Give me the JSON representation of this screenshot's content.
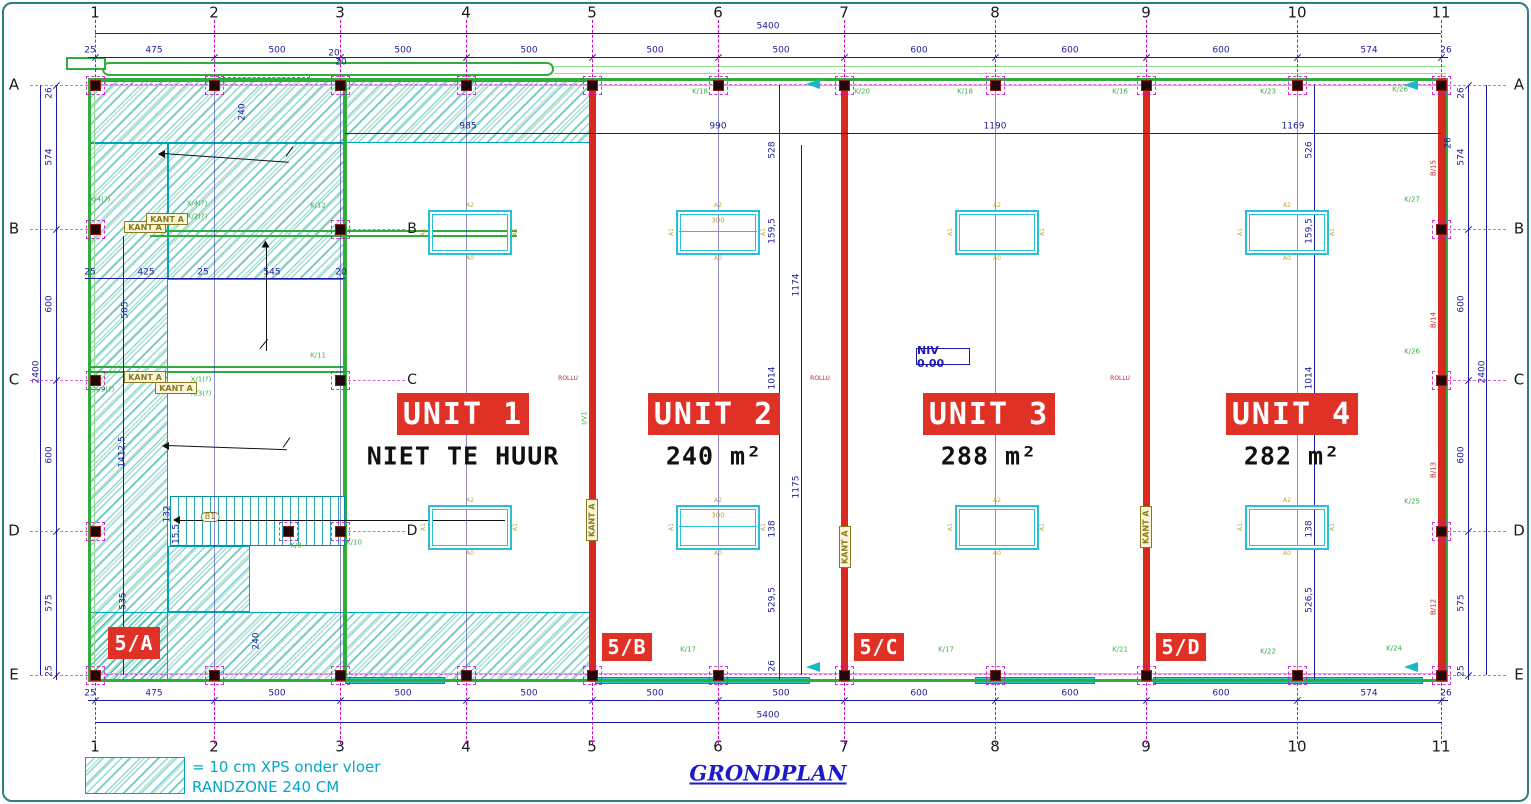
{
  "meta": {
    "title": "GRONDPLAN"
  },
  "colors": {
    "wall_red": "#d8291f",
    "wall_green": "#2fae3e",
    "teal": "#00b3c8",
    "dim_navy": "#1b1b9e",
    "grid_magenta": "#cc00cc",
    "label_green": "#3cb043",
    "banner_red": "#e03127",
    "khaki": "#8a7a1e",
    "niv_blue": "#1b1bb0",
    "legend_cyan": "#00a8cc"
  },
  "legend": {
    "line1": "= 10 cm XPS onder vloer",
    "line2": "RANDZONE 240 CM"
  },
  "niv": {
    "text": "NIV 0.00"
  },
  "kant_text": "KANT A",
  "grid": {
    "cols": [
      {
        "n": "1",
        "x": 95
      },
      {
        "n": "2",
        "x": 214
      },
      {
        "n": "3",
        "x": 340
      },
      {
        "n": "4",
        "x": 466
      },
      {
        "n": "5",
        "x": 592
      },
      {
        "n": "6",
        "x": 718
      },
      {
        "n": "7",
        "x": 844
      },
      {
        "n": "8",
        "x": 995
      },
      {
        "n": "9",
        "x": 1146
      },
      {
        "n": "10",
        "x": 1297
      },
      {
        "n": "11",
        "x": 1441
      }
    ],
    "inner_cols": [
      "2",
      "3",
      "4",
      "6",
      "8",
      "10"
    ],
    "rows": [
      {
        "n": "A",
        "y": 85
      },
      {
        "n": "B",
        "y": 229
      },
      {
        "n": "C",
        "y": 380
      },
      {
        "n": "D",
        "y": 531
      },
      {
        "n": "E",
        "y": 675
      }
    ]
  },
  "letters_inner": [
    {
      "n": "B",
      "x": 412,
      "y": 229
    },
    {
      "n": "C",
      "x": 412,
      "y": 380
    },
    {
      "n": "D",
      "x": 412,
      "y": 531
    }
  ],
  "banners": [
    {
      "label": "UNIT 1",
      "sub": "NIET TE HUUR",
      "bx": 397,
      "by": 393,
      "bw": 132,
      "bh": 42,
      "sx": 463,
      "sy": 456
    },
    {
      "label": "UNIT 2",
      "sub": "240 m²",
      "bx": 648,
      "by": 393,
      "bw": 132,
      "bh": 42,
      "sx": 714,
      "sy": 456
    },
    {
      "label": "UNIT 3",
      "sub": "288 m²",
      "bx": 923,
      "by": 393,
      "bw": 132,
      "bh": 42,
      "sx": 989,
      "sy": 456
    },
    {
      "label": "UNIT 4",
      "sub": "282 m²",
      "bx": 1226,
      "by": 393,
      "bw": 132,
      "bh": 42,
      "sx": 1292,
      "sy": 456
    }
  ],
  "zones": [
    {
      "label": "5/A",
      "x": 108,
      "y": 627,
      "w": 52,
      "h": 32
    },
    {
      "label": "5/B",
      "x": 602,
      "y": 633,
      "w": 50,
      "h": 28
    },
    {
      "label": "5/C",
      "x": 854,
      "y": 633,
      "w": 50,
      "h": 28
    },
    {
      "label": "5/D",
      "x": 1156,
      "y": 633,
      "w": 50,
      "h": 28
    }
  ],
  "kant": [
    {
      "x": 124,
      "y": 221
    },
    {
      "x": 146,
      "y": 213
    },
    {
      "x": 124,
      "y": 371
    },
    {
      "x": 155,
      "y": 382
    },
    {
      "x": 586,
      "y": 499,
      "v": 1
    },
    {
      "x": 839,
      "y": 526,
      "v": 1
    },
    {
      "x": 1140,
      "y": 506,
      "v": 1
    }
  ],
  "sky_labels": {
    "top": "A2",
    "bottom": "A0",
    "side": "A1"
  },
  "sky": [
    {
      "x": 428,
      "y": 210
    },
    {
      "x": 676,
      "y": 210,
      "mid": 1,
      "num": "300"
    },
    {
      "x": 955,
      "y": 210
    },
    {
      "x": 1245,
      "y": 210
    },
    {
      "x": 428,
      "y": 505
    },
    {
      "x": 676,
      "y": 505,
      "mid": 1,
      "num": "300"
    },
    {
      "x": 955,
      "y": 505
    },
    {
      "x": 1245,
      "y": 505
    }
  ],
  "columns_xy": [
    [
      95,
      85
    ],
    [
      214,
      85
    ],
    [
      340,
      85
    ],
    [
      466,
      85
    ],
    [
      592,
      85
    ],
    [
      718,
      85
    ],
    [
      844,
      85
    ],
    [
      995,
      85
    ],
    [
      1146,
      85
    ],
    [
      1297,
      85
    ],
    [
      1441,
      85
    ],
    [
      95,
      675
    ],
    [
      214,
      675
    ],
    [
      340,
      675
    ],
    [
      466,
      675
    ],
    [
      592,
      675
    ],
    [
      718,
      675
    ],
    [
      844,
      675
    ],
    [
      995,
      675
    ],
    [
      1146,
      675
    ],
    [
      1297,
      675
    ],
    [
      1441,
      675
    ],
    [
      95,
      229
    ],
    [
      95,
      380
    ],
    [
      95,
      531
    ],
    [
      340,
      229
    ],
    [
      340,
      380
    ],
    [
      340,
      531
    ],
    [
      1441,
      229
    ],
    [
      1441,
      380
    ],
    [
      1441,
      531
    ],
    [
      288,
      531
    ]
  ],
  "shapes": [
    {
      "k": "hatch",
      "x": 88,
      "y": 81,
      "w": 502,
      "h": 62
    },
    {
      "k": "hatch",
      "x": 88,
      "y": 143,
      "w": 80,
      "h": 537
    },
    {
      "k": "hatch",
      "x": 168,
      "y": 143,
      "w": 177,
      "h": 137
    },
    {
      "k": "hatch",
      "x": 168,
      "y": 546,
      "w": 82,
      "h": 66
    },
    {
      "k": "hatch",
      "x": 88,
      "y": 612,
      "w": 502,
      "h": 68
    },
    {
      "k": "cyd",
      "x": 218,
      "y": 67,
      "w": 92,
      "h": 11
    },
    {
      "k": "teal",
      "x": 345,
      "y": 677,
      "w": 100,
      "h": 7
    },
    {
      "k": "teal",
      "x": 595,
      "y": 677,
      "w": 215,
      "h": 7
    },
    {
      "k": "teal",
      "x": 975,
      "y": 677,
      "w": 120,
      "h": 7
    },
    {
      "k": "teal",
      "x": 1153,
      "y": 677,
      "w": 270,
      "h": 7
    },
    {
      "k": "gwl",
      "x": 94,
      "y": 85,
      "w": 1348,
      "h": 1
    },
    {
      "k": "gwl",
      "x": 94,
      "y": 673,
      "w": 1348,
      "h": 1
    },
    {
      "k": "gwl",
      "x": 94,
      "y": 85,
      "w": 1,
      "h": 589
    },
    {
      "k": "gwl",
      "x": 1441,
      "y": 85,
      "w": 1,
      "h": 589
    },
    {
      "k": "gwl",
      "x": 554,
      "y": 66,
      "w": 892,
      "h": 1
    },
    {
      "k": "gwl",
      "x": 554,
      "y": 73,
      "w": 892,
      "h": 1
    },
    {
      "k": "cap",
      "x": 102,
      "y": 62,
      "w": 452,
      "h": 14
    },
    {
      "k": "cap2",
      "x": 66,
      "y": 57,
      "w": 40,
      "h": 13
    },
    {
      "k": "gw",
      "x": 88,
      "y": 78,
      "w": 1360,
      "h": 3
    },
    {
      "k": "gw",
      "x": 88,
      "y": 679,
      "w": 1360,
      "h": 3
    },
    {
      "k": "gw",
      "x": 88,
      "y": 78,
      "w": 3,
      "h": 604
    },
    {
      "k": "gw",
      "x": 1445,
      "y": 78,
      "w": 3,
      "h": 604
    },
    {
      "k": "gw",
      "x": 343,
      "y": 81,
      "w": 4,
      "h": 598
    },
    {
      "k": "gw2",
      "x": 150,
      "y": 230,
      "w": 367,
      "h": 2
    },
    {
      "k": "gw2",
      "x": 150,
      "y": 235,
      "w": 367,
      "h": 2
    },
    {
      "k": "gw2",
      "x": 88,
      "y": 366,
      "w": 257,
      "h": 2
    },
    {
      "k": "gw2",
      "x": 88,
      "y": 371,
      "w": 257,
      "h": 2
    },
    {
      "k": "rw",
      "x": 589,
      "y": 82,
      "w": 7,
      "h": 600
    },
    {
      "k": "rw",
      "x": 841,
      "y": 82,
      "w": 7,
      "h": 600
    },
    {
      "k": "rw",
      "x": 1143,
      "y": 82,
      "w": 7,
      "h": 600
    },
    {
      "k": "rw",
      "x": 1438,
      "y": 78,
      "w": 8,
      "h": 604
    },
    {
      "k": "stair",
      "x": 170,
      "y": 496,
      "w": 175,
      "h": 50
    },
    {
      "k": "dl",
      "x": 95,
      "y": 33,
      "w": 1346,
      "h": 1
    },
    {
      "k": "dl",
      "x": 88,
      "y": 57,
      "w": 1360,
      "h": 1
    },
    {
      "k": "dl",
      "x": 88,
      "y": 700,
      "w": 1360,
      "h": 1
    },
    {
      "k": "dl",
      "x": 95,
      "y": 722,
      "w": 1346,
      "h": 1
    },
    {
      "k": "dl",
      "x": 56,
      "y": 85,
      "w": 1,
      "h": 595
    },
    {
      "k": "dl",
      "x": 40,
      "y": 85,
      "w": 1,
      "h": 590
    },
    {
      "k": "dl",
      "x": 1468,
      "y": 85,
      "w": 1,
      "h": 595
    },
    {
      "k": "dl",
      "x": 1486,
      "y": 85,
      "w": 1,
      "h": 590
    },
    {
      "k": "dl",
      "x": 345,
      "y": 133,
      "w": 1096,
      "h": 1
    },
    {
      "k": "dl",
      "x": 779,
      "y": 85,
      "w": 1,
      "h": 595
    },
    {
      "k": "dl",
      "x": 801,
      "y": 145,
      "w": 1,
      "h": 530
    },
    {
      "k": "dl",
      "x": 1314,
      "y": 85,
      "w": 1,
      "h": 595
    },
    {
      "k": "dl",
      "x": 85,
      "y": 278,
      "w": 260,
      "h": 1
    },
    {
      "k": "dl",
      "x": 123,
      "y": 236,
      "w": 1,
      "h": 439
    },
    {
      "k": "mgh",
      "x": 90,
      "y": 84,
      "w": 1356
    },
    {
      "k": "mgh",
      "x": 90,
      "y": 674,
      "w": 1356
    },
    {
      "k": "arr",
      "x": 180,
      "y": 520,
      "w": 325,
      "h": 1
    },
    {
      "k": "ah",
      "x": 173,
      "y": 516
    },
    {
      "k": "arr",
      "x": 163,
      "y": 153,
      "w": 126,
      "h": 1,
      "r": 4
    },
    {
      "k": "ah",
      "x": 158,
      "y": 150
    },
    {
      "k": "arr",
      "x": 286,
      "y": 156,
      "w": 12,
      "h": 1,
      "r": -55
    },
    {
      "k": "arr",
      "x": 266,
      "y": 243,
      "w": 1,
      "h": 108
    },
    {
      "k": "ah",
      "x": 262,
      "y": 240,
      "r": 90
    },
    {
      "k": "arr",
      "x": 260,
      "y": 348,
      "w": 12,
      "h": 1,
      "r": -50
    },
    {
      "k": "arr",
      "x": 167,
      "y": 445,
      "w": 120,
      "h": 1,
      "r": 2
    },
    {
      "k": "ah",
      "x": 162,
      "y": 442
    },
    {
      "k": "arr",
      "x": 283,
      "y": 447,
      "w": 12,
      "h": 1,
      "r": -55
    },
    {
      "k": "cya",
      "x": 806,
      "y": 79
    },
    {
      "k": "cya",
      "x": 1404,
      "y": 80
    },
    {
      "k": "cya",
      "x": 806,
      "y": 662
    },
    {
      "k": "cya",
      "x": 1404,
      "y": 662
    }
  ],
  "texts": [
    {
      "s": "5400",
      "x": 768,
      "y": 27
    },
    {
      "s": "5400",
      "x": 768,
      "y": 716
    },
    {
      "s": "25",
      "x": 90,
      "y": 51
    },
    {
      "s": "475",
      "x": 154,
      "y": 51
    },
    {
      "s": "500",
      "x": 277,
      "y": 51
    },
    {
      "s": "500",
      "x": 403,
      "y": 51
    },
    {
      "s": "500",
      "x": 529,
      "y": 51
    },
    {
      "s": "500",
      "x": 655,
      "y": 51
    },
    {
      "s": "500",
      "x": 781,
      "y": 51
    },
    {
      "s": "600",
      "x": 919,
      "y": 51
    },
    {
      "s": "600",
      "x": 1070,
      "y": 51
    },
    {
      "s": "600",
      "x": 1221,
      "y": 51
    },
    {
      "s": "574",
      "x": 1369,
      "y": 51
    },
    {
      "s": "26",
      "x": 1446,
      "y": 51
    },
    {
      "s": "25",
      "x": 90,
      "y": 694
    },
    {
      "s": "475",
      "x": 154,
      "y": 694
    },
    {
      "s": "500",
      "x": 277,
      "y": 694
    },
    {
      "s": "500",
      "x": 403,
      "y": 694
    },
    {
      "s": "500",
      "x": 529,
      "y": 694
    },
    {
      "s": "500",
      "x": 655,
      "y": 694
    },
    {
      "s": "500",
      "x": 781,
      "y": 694
    },
    {
      "s": "600",
      "x": 919,
      "y": 694
    },
    {
      "s": "600",
      "x": 1070,
      "y": 694
    },
    {
      "s": "600",
      "x": 1221,
      "y": 694
    },
    {
      "s": "574",
      "x": 1369,
      "y": 694
    },
    {
      "s": "26",
      "x": 1446,
      "y": 694
    },
    {
      "s": "26",
      "x": 50,
      "y": 93,
      "r": 1
    },
    {
      "s": "574",
      "x": 50,
      "y": 157,
      "r": 1
    },
    {
      "s": "600",
      "x": 50,
      "y": 304,
      "r": 1
    },
    {
      "s": "600",
      "x": 50,
      "y": 455,
      "r": 1
    },
    {
      "s": "575",
      "x": 50,
      "y": 603,
      "r": 1
    },
    {
      "s": "25",
      "x": 50,
      "y": 671,
      "r": 1
    },
    {
      "s": "2400",
      "x": 37,
      "y": 372,
      "r": 1
    },
    {
      "s": "26",
      "x": 1462,
      "y": 93,
      "r": 1
    },
    {
      "s": "574",
      "x": 1462,
      "y": 157,
      "r": 1
    },
    {
      "s": "600",
      "x": 1462,
      "y": 304,
      "r": 1
    },
    {
      "s": "600",
      "x": 1462,
      "y": 455,
      "r": 1
    },
    {
      "s": "575",
      "x": 1462,
      "y": 603,
      "r": 1
    },
    {
      "s": "25",
      "x": 1462,
      "y": 671,
      "r": 1
    },
    {
      "s": "2400",
      "x": 1483,
      "y": 372,
      "r": 1
    },
    {
      "s": "985",
      "x": 468,
      "y": 127
    },
    {
      "s": "990",
      "x": 718,
      "y": 127
    },
    {
      "s": "1190",
      "x": 995,
      "y": 127
    },
    {
      "s": "1169",
      "x": 1293,
      "y": 127
    },
    {
      "s": "26",
      "x": 1449,
      "y": 143,
      "r": 1
    },
    {
      "s": "528",
      "x": 773,
      "y": 150,
      "r": 1
    },
    {
      "s": "159,5",
      "x": 773,
      "y": 231,
      "r": 1
    },
    {
      "s": "1174",
      "x": 797,
      "y": 285,
      "r": 1
    },
    {
      "s": "1014",
      "x": 773,
      "y": 378,
      "r": 1
    },
    {
      "s": "138",
      "x": 773,
      "y": 529,
      "r": 1
    },
    {
      "s": "1175",
      "x": 797,
      "y": 487,
      "r": 1
    },
    {
      "s": "529,5",
      "x": 773,
      "y": 600,
      "r": 1
    },
    {
      "s": "26",
      "x": 773,
      "y": 666,
      "r": 1
    },
    {
      "s": "526",
      "x": 1310,
      "y": 150,
      "r": 1
    },
    {
      "s": "159,5",
      "x": 1310,
      "y": 231,
      "r": 1
    },
    {
      "s": "1014",
      "x": 1310,
      "y": 378,
      "r": 1
    },
    {
      "s": "138",
      "x": 1310,
      "y": 529,
      "r": 1
    },
    {
      "s": "526,5",
      "x": 1310,
      "y": 600,
      "r": 1
    },
    {
      "s": "25",
      "x": 90,
      "y": 273
    },
    {
      "s": "425",
      "x": 146,
      "y": 273
    },
    {
      "s": "25",
      "x": 203,
      "y": 273
    },
    {
      "s": "545",
      "x": 272,
      "y": 273
    },
    {
      "s": "20",
      "x": 341,
      "y": 273
    },
    {
      "s": "505",
      "x": 126,
      "y": 310,
      "r": 1
    },
    {
      "s": "1412,5",
      "x": 123,
      "y": 452,
      "r": 1
    },
    {
      "s": "535",
      "x": 124,
      "y": 601,
      "r": 1
    },
    {
      "s": "240",
      "x": 243,
      "y": 112,
      "r": 1
    },
    {
      "s": "240",
      "x": 257,
      "y": 641,
      "r": 1
    },
    {
      "s": "132",
      "x": 168,
      "y": 514,
      "r": 1
    },
    {
      "s": "15,5",
      "x": 177,
      "y": 534,
      "r": 1
    },
    {
      "s": "20",
      "x": 334,
      "y": 54
    },
    {
      "s": "20",
      "x": 341,
      "y": 63
    },
    {
      "s": "K/18",
      "x": 700,
      "y": 92,
      "c": "kl"
    },
    {
      "s": "K/20",
      "x": 862,
      "y": 92,
      "c": "kl"
    },
    {
      "s": "K/18",
      "x": 965,
      "y": 92,
      "c": "kl"
    },
    {
      "s": "K/16",
      "x": 1120,
      "y": 92,
      "c": "kl"
    },
    {
      "s": "K/23",
      "x": 1268,
      "y": 92,
      "c": "kl"
    },
    {
      "s": "K/26",
      "x": 1400,
      "y": 90,
      "c": "kl"
    },
    {
      "s": "K/17",
      "x": 688,
      "y": 650,
      "c": "kl"
    },
    {
      "s": "K/17",
      "x": 946,
      "y": 650,
      "c": "kl"
    },
    {
      "s": "K/21",
      "x": 1120,
      "y": 650,
      "c": "kl"
    },
    {
      "s": "K/22",
      "x": 1268,
      "y": 652,
      "c": "kl"
    },
    {
      "s": "K/24",
      "x": 1394,
      "y": 649,
      "c": "kl"
    },
    {
      "s": "K/12",
      "x": 318,
      "y": 206,
      "c": "kl"
    },
    {
      "s": "K/11",
      "x": 318,
      "y": 356,
      "c": "kl"
    },
    {
      "s": "K/10",
      "x": 354,
      "y": 543,
      "c": "kl"
    },
    {
      "s": "K/8",
      "x": 296,
      "y": 546,
      "c": "kl"
    },
    {
      "s": "K/27",
      "x": 1412,
      "y": 200,
      "c": "kl"
    },
    {
      "s": "K/26",
      "x": 1412,
      "y": 352,
      "c": "kl"
    },
    {
      "s": "K/25",
      "x": 1412,
      "y": 502,
      "c": "kl"
    },
    {
      "s": "K/4(?)",
      "x": 100,
      "y": 200,
      "c": "kl"
    },
    {
      "s": "X/9(?)",
      "x": 104,
      "y": 390,
      "c": "kl"
    },
    {
      "s": "X/4(?)",
      "x": 197,
      "y": 204,
      "c": "kl"
    },
    {
      "s": "X/2(?)",
      "x": 197,
      "y": 217,
      "c": "kl"
    },
    {
      "s": "X/1(?)",
      "x": 201,
      "y": 380,
      "c": "kl"
    },
    {
      "s": "X/3(?)",
      "x": 201,
      "y": 394,
      "c": "kl"
    },
    {
      "s": "I/V1",
      "x": 585,
      "y": 418,
      "c": "kl",
      "r": 1
    },
    {
      "s": "B/15",
      "x": 1434,
      "y": 168,
      "c": "br",
      "r": 1
    },
    {
      "s": "B/14",
      "x": 1434,
      "y": 320,
      "c": "br",
      "r": 1
    },
    {
      "s": "B/13",
      "x": 1434,
      "y": 470,
      "c": "br",
      "r": 1
    },
    {
      "s": "B/12",
      "x": 1434,
      "y": 607,
      "c": "br",
      "r": 1
    },
    {
      "s": "ROLLU",
      "x": 568,
      "y": 379,
      "c": "ro"
    },
    {
      "s": "ROLLU",
      "x": 820,
      "y": 379,
      "c": "ro"
    },
    {
      "s": "ROLLU",
      "x": 1120,
      "y": 379,
      "c": "ro"
    },
    {
      "s": "B1",
      "x": 210,
      "y": 517,
      "c": "b1"
    }
  ]
}
